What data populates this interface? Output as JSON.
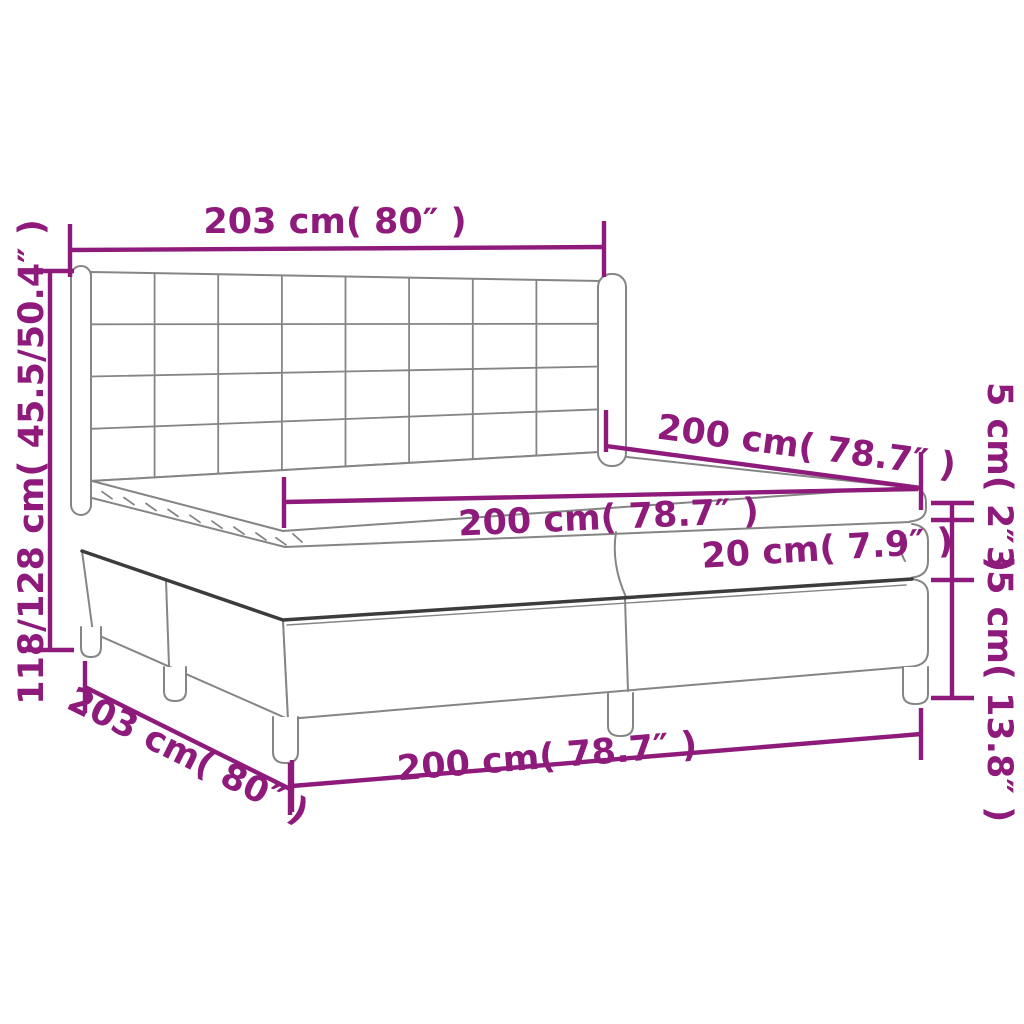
{
  "diagram": {
    "type": "furniture-dimension-diagram",
    "subject": "box spring bed with tufted wing headboard, two-piece base, mattress and pillow top",
    "accent_color": "#8e1b7b",
    "outline_color": "#858585",
    "strong_edge_color": "#3c3c3c",
    "background_color": "#ffffff",
    "labels": {
      "headboard_width": "203 cm( 80″ )",
      "total_height": "118/128 cm( 45.5/50.4″ )",
      "mattress_depth": "200 cm( 78.7″ )",
      "mattress_width": "200 cm( 78.7″ )",
      "topper_height": "5 cm( 2″ )",
      "mattress_height": "20 cm( 7.9″ )",
      "base_height": "35 cm( 13.8″ )",
      "base_width": "200 cm( 78.7″ )",
      "frame_depth": "203 cm( 80″ )"
    },
    "measurements": [
      {
        "name": "headboard-width",
        "value_cm": "203",
        "value_in": "80"
      },
      {
        "name": "total-height",
        "value_cm": "118/128",
        "value_in": "45.5/50.4"
      },
      {
        "name": "mattress-depth",
        "value_cm": "200",
        "value_in": "78.7"
      },
      {
        "name": "mattress-width",
        "value_cm": "200",
        "value_in": "78.7"
      },
      {
        "name": "topper-height",
        "value_cm": "5",
        "value_in": "2"
      },
      {
        "name": "mattress-height",
        "value_cm": "20",
        "value_in": "7.9"
      },
      {
        "name": "base-height",
        "value_cm": "35",
        "value_in": "13.8"
      },
      {
        "name": "base-width",
        "value_cm": "200",
        "value_in": "78.7"
      },
      {
        "name": "frame-depth",
        "value_cm": "203",
        "value_in": "80"
      }
    ]
  }
}
